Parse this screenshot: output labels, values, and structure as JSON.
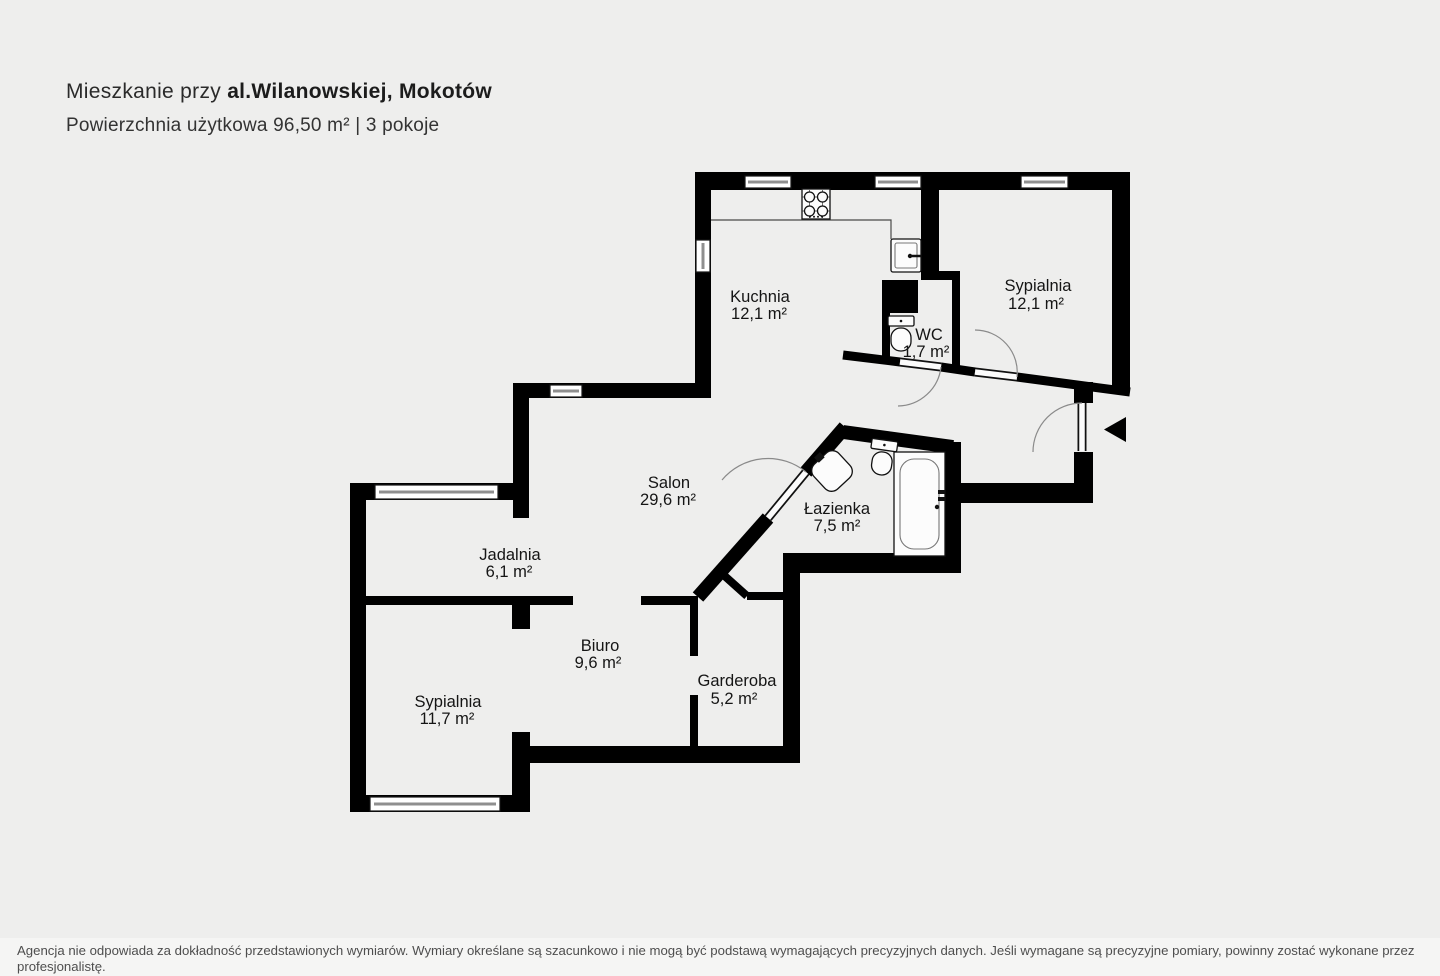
{
  "header": {
    "title_prefix": "Mieszkanie przy ",
    "title_bold": "al.Wilanowskiej, Mokotów",
    "subtitle": "Powierzchnia użytkowa 96,50 m² | 3 pokoje"
  },
  "rooms": {
    "kuchnia": {
      "name": "Kuchnia",
      "area": "12,1 m²"
    },
    "sypialnia_gorna": {
      "name": "Sypialnia",
      "area": "12,1 m²"
    },
    "wc": {
      "name": "WC",
      "area": "1,7 m²"
    },
    "salon": {
      "name": "Salon",
      "area": "29,6 m²"
    },
    "lazienka": {
      "name": "Łazienka",
      "area": "7,5 m²"
    },
    "jadalnia": {
      "name": "Jadalnia",
      "area": "6,1 m²"
    },
    "biuro": {
      "name": "Biuro",
      "area": "9,6 m²"
    },
    "garderoba": {
      "name": "Garderoba",
      "area": "5,2 m²"
    },
    "sypialnia_dolna": {
      "name": "Sypialnia",
      "area": "11,7 m²"
    }
  },
  "icons": {
    "entrance_arrow": "◀ left-filled-triangle"
  },
  "colors": {
    "wall": "#000000",
    "background": "#eeeeed",
    "footer_bar": "#f5f5f4",
    "fixture_fill": "#fcfcfc"
  },
  "footer": {
    "disclaimer": "Agencja nie odpowiada za dokładność przedstawionych wymiarów. Wymiary określane są szacunkowo i nie mogą być podstawą wymagających precyzyjnych danych. Jeśli wymagane są precyzyjne pomiary, powinny zostać wykonane przez profesjonalistę."
  }
}
